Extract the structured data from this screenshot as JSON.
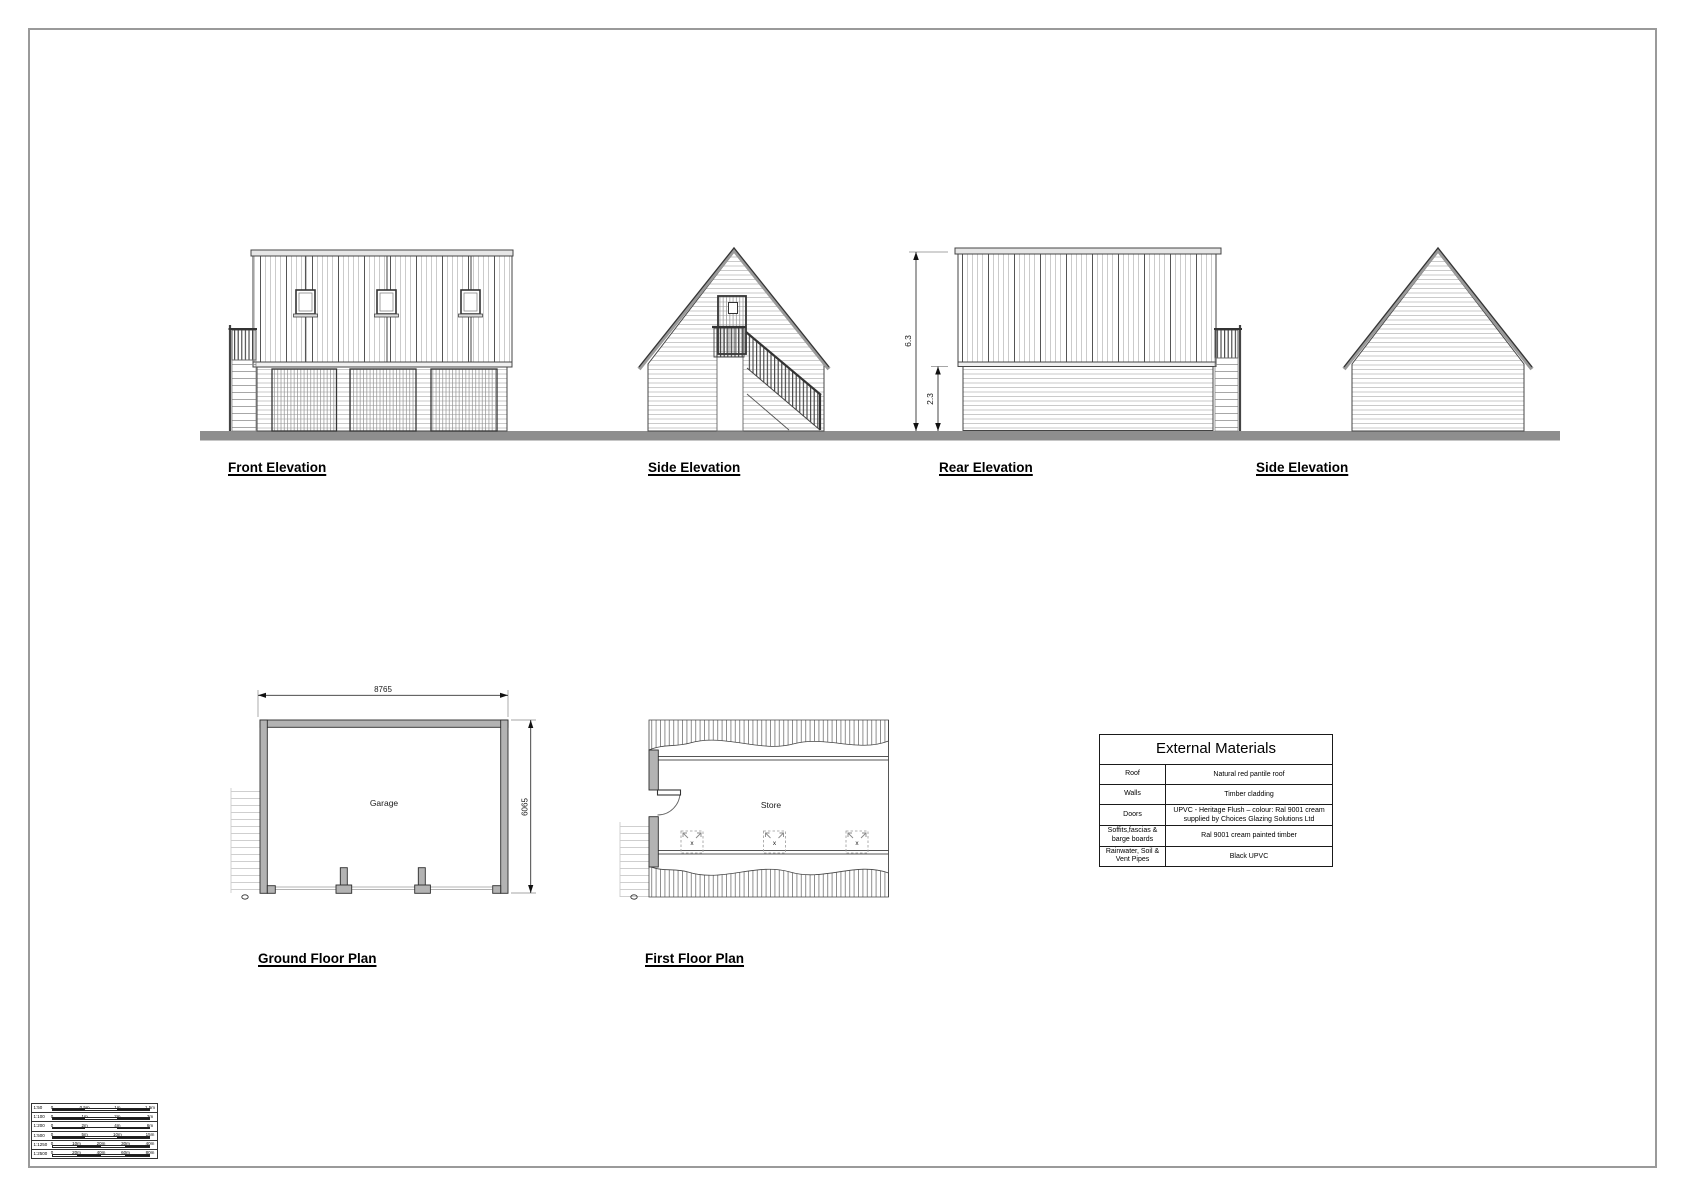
{
  "sheet": {
    "background": "#ffffff",
    "frame_color": "#9a9a9a"
  },
  "colors": {
    "ground_line": "#8e8e8e",
    "plan_wall_fill": "#b3b3b3",
    "linework": "#444444"
  },
  "elevations": {
    "front": {
      "label": "Front Elevation"
    },
    "side_left": {
      "label": "Side Elevation"
    },
    "rear": {
      "label": "Rear Elevation",
      "overall_height": "6.3",
      "eaves_height": "2.3"
    },
    "side_right": {
      "label": "Side Elevation"
    }
  },
  "plans": {
    "ground": {
      "label": "Ground Floor Plan",
      "room_label": "Garage",
      "width_dim": "8765",
      "depth_dim": "6065"
    },
    "first": {
      "label": "First Floor Plan",
      "room_label": "Store",
      "rooflight_mark": "x"
    }
  },
  "materials_table": {
    "title": "External Materials",
    "rows": [
      {
        "item": "Roof",
        "spec": "Natural red pantile roof"
      },
      {
        "item": "Walls",
        "spec": "Timber cladding"
      },
      {
        "item": "Doors",
        "spec": "UPVC - Heritage Flush – colour: Ral 9001 cream supplied by Choices Glazing Solutions Ltd"
      },
      {
        "item": "Soffits,fascias & barge boards",
        "spec": "Ral 9001 cream painted timber"
      },
      {
        "item": "Rainwater, Soil & Vent Pipes",
        "spec": "Black UPVC"
      }
    ]
  },
  "scale_bars": {
    "rows": [
      {
        "scale": "1:50",
        "ticks": [
          "0",
          "0.5m",
          "1m",
          "1.5m"
        ]
      },
      {
        "scale": "1:100",
        "ticks": [
          "0",
          "1m",
          "2m",
          "3m"
        ]
      },
      {
        "scale": "1:200",
        "ticks": [
          "0",
          "2m",
          "4m",
          "6m"
        ]
      },
      {
        "scale": "1:500",
        "ticks": [
          "0",
          "5m",
          "10m",
          "15m"
        ]
      },
      {
        "scale": "1:1250",
        "ticks": [
          "0",
          "10m",
          "20m",
          "30m",
          "40m"
        ]
      },
      {
        "scale": "1:2500",
        "ticks": [
          "0",
          "20m",
          "40m",
          "60m",
          "80m"
        ]
      }
    ]
  }
}
